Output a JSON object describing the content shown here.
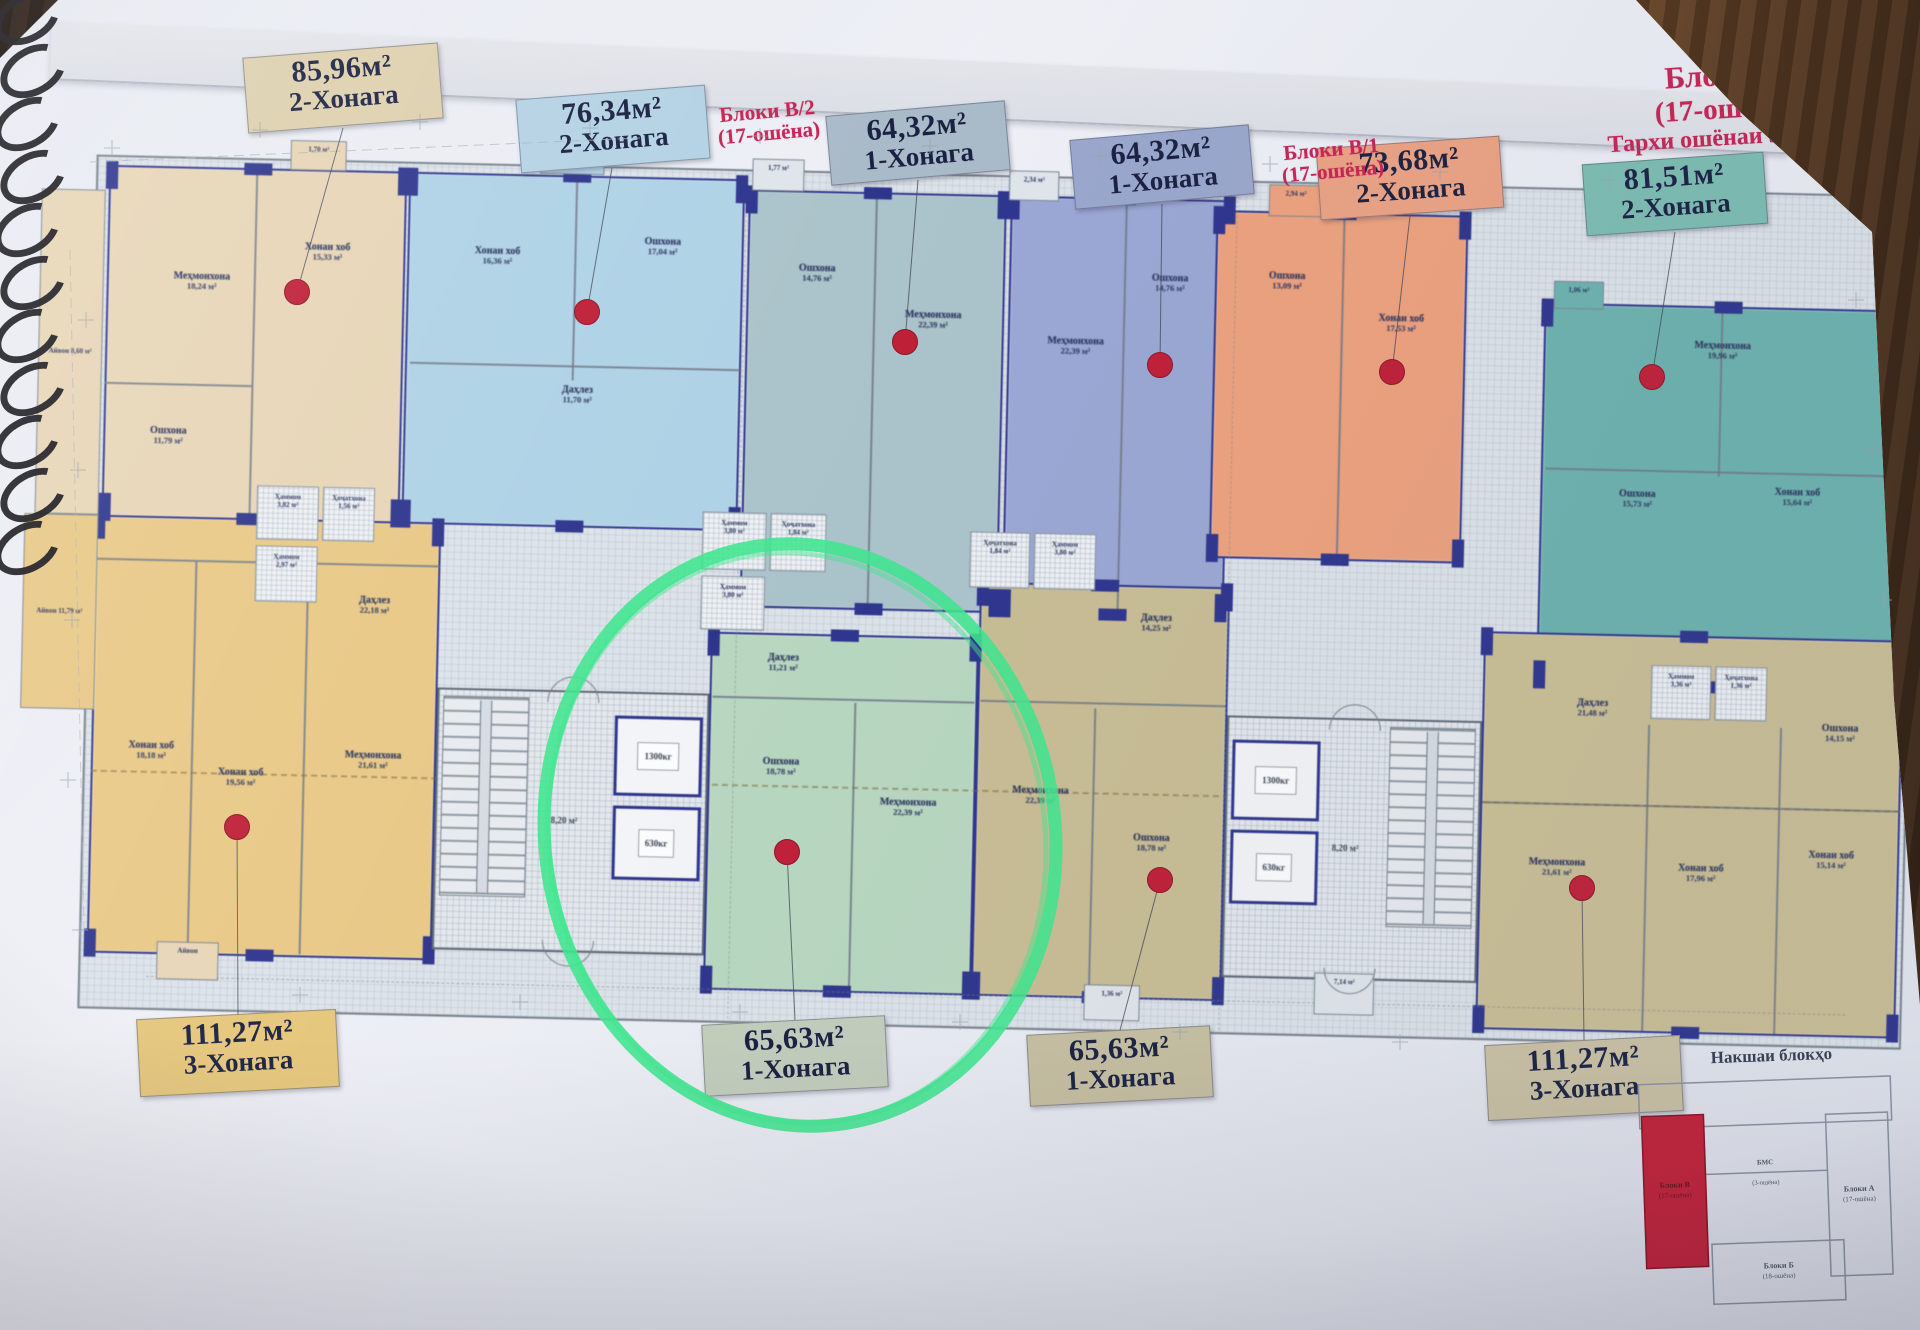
{
  "photo": {
    "paper_color": "#eaedf3",
    "accent_red": "#c62454",
    "wall_navy": "#2d3590",
    "marker_green": "#3fe68e",
    "dot_red": "#bf2038"
  },
  "header": {
    "title": {
      "line1": "Блоки В",
      "line2": "(17-ошёна)",
      "line3": "Тархи ошёнаи 5-16 ум"
    },
    "note_left": {
      "line1": "Блоки В/2",
      "line2": "(17-ошёна)"
    },
    "note_right": {
      "line1": "Блоки В/1",
      "line2": "(17-ошёна)"
    }
  },
  "tags": [
    {
      "id": "t8596",
      "area": "85,96м²",
      "rooms": "2-Хонага",
      "bg": "#ddd0ae",
      "x": 245,
      "y": 50,
      "w": 196,
      "h": 76,
      "rot": -4.5,
      "dot": [
        297,
        292
      ],
      "anchor": [
        343,
        128
      ]
    },
    {
      "id": "t7634",
      "area": "76,34м²",
      "rooms": "2-Хонага",
      "bg": "#b4d2e4",
      "x": 518,
      "y": 92,
      "w": 190,
      "h": 74,
      "rot": -4.5,
      "dot": [
        587,
        312
      ],
      "anchor": [
        612,
        168
      ]
    },
    {
      "id": "t6432a",
      "area": "64,32м²",
      "rooms": "1-Хонага",
      "bg": "#a9bac9",
      "x": 828,
      "y": 108,
      "w": 180,
      "h": 70,
      "rot": -5,
      "dot": [
        905,
        342
      ],
      "anchor": [
        918,
        180
      ]
    },
    {
      "id": "t6432b",
      "area": "64,32м²",
      "rooms": "1-Хонага",
      "bg": "#9aa7cc",
      "x": 1072,
      "y": 132,
      "w": 180,
      "h": 70,
      "rot": -5,
      "dot": [
        1160,
        365
      ],
      "anchor": [
        1162,
        204
      ]
    },
    {
      "id": "t7368",
      "area": "73,68м²",
      "rooms": "2-Хонага",
      "bg": "#eaa284",
      "x": 1318,
      "y": 142,
      "w": 184,
      "h": 72,
      "rot": -4,
      "dot": [
        1392,
        372
      ],
      "anchor": [
        1410,
        216
      ]
    },
    {
      "id": "t8151",
      "area": "81,51м²",
      "rooms": "2-Хонага",
      "bg": "#7cbcb1",
      "x": 1584,
      "y": 158,
      "w": 182,
      "h": 72,
      "rot": -4,
      "dot": [
        1652,
        377
      ],
      "anchor": [
        1675,
        232
      ]
    },
    {
      "id": "t11127L",
      "area": "111,27м²",
      "rooms": "3-Хонага",
      "bg": "#e5c67b",
      "x": 138,
      "y": 1014,
      "w": 200,
      "h": 78,
      "rot": -3,
      "dot": [
        237,
        827
      ],
      "anchor": [
        238,
        1014
      ]
    },
    {
      "id": "t6563L",
      "area": "65,63м²",
      "rooms": "1-Хонага",
      "bg": "#c2cdbc",
      "x": 703,
      "y": 1020,
      "w": 184,
      "h": 72,
      "rot": -3,
      "dot": [
        787,
        852
      ],
      "anchor": [
        795,
        1020
      ]
    },
    {
      "id": "t6563R",
      "area": "65,63м²",
      "rooms": "1-Хонага",
      "bg": "#c6bfa1",
      "x": 1028,
      "y": 1030,
      "w": 184,
      "h": 72,
      "rot": -3,
      "dot": [
        1160,
        880
      ],
      "anchor": [
        1120,
        1030
      ]
    },
    {
      "id": "t11127R",
      "area": "111,27м²",
      "rooms": "3-Хонага",
      "bg": "#cac2a4",
      "x": 1486,
      "y": 1040,
      "w": 196,
      "h": 76,
      "rot": -3,
      "dot": [
        1582,
        888
      ],
      "anchor": [
        1584,
        1040
      ]
    }
  ],
  "plan": {
    "units": [
      {
        "id": "85-96",
        "color": "#e8d5b5",
        "rect": [
          5,
          35,
          298,
          352
        ],
        "rooms": [
          {
            "l": "Меҳмонхона",
            "a": "18,24 м²",
            "x": 100,
            "y": 150
          },
          {
            "l": "Хонаи хоб",
            "a": "15,33 м²",
            "x": 225,
            "y": 118
          },
          {
            "l": "Ошхона",
            "a": "11,79 м²",
            "x": 70,
            "y": 305
          }
        ],
        "dividers": [
          [
            152,
            40,
            2,
            345
          ],
          [
            5,
            252,
            148,
            2
          ]
        ]
      },
      {
        "id": "76-34",
        "color": "#aed2e7",
        "rect": [
          305,
          35,
          336,
          352
        ],
        "rooms": [
          {
            "l": "Хонаи хоб",
            "a": "16,36 м²",
            "x": 395,
            "y": 118
          },
          {
            "l": "Ошхона",
            "a": "17,04 м²",
            "x": 560,
            "y": 105
          },
          {
            "l": "Даҳлез",
            "a": "11,70 м²",
            "x": 478,
            "y": 255
          }
        ],
        "dividers": [
          [
            472,
            40,
            2,
            200
          ],
          [
            310,
            225,
            330,
            2
          ]
        ]
      },
      {
        "id": "64-32-a",
        "color": "#aac3ca",
        "rect": [
          645,
          45,
          258,
          418
        ],
        "rooms": [
          {
            "l": "Ошхона",
            "a": "14,76 м²",
            "x": 715,
            "y": 128
          },
          {
            "l": "Меҳмонхона",
            "a": "22,39 м²",
            "x": 832,
            "y": 172
          }
        ],
        "dividers": [
          [
            772,
            50,
            2,
            408
          ]
        ]
      },
      {
        "id": "64-32-b",
        "color": "#9aa7d6",
        "rect": [
          907,
          45,
          222,
          418
        ],
        "rooms": [
          {
            "l": "Меҳмонхона",
            "a": "22,39 м²",
            "x": 975,
            "y": 195
          },
          {
            "l": "Ошхона",
            "a": "14,76 м²",
            "x": 1068,
            "y": 130
          }
        ],
        "dividers": [
          [
            1022,
            50,
            2,
            408
          ]
        ]
      },
      {
        "id": "73-68",
        "color": "#efa07b",
        "rect": [
          1113,
          55,
          252,
          348
        ],
        "rooms": [
          {
            "l": "Ошхона",
            "a": "13,09 м²",
            "x": 1185,
            "y": 125
          },
          {
            "l": "Хонаи хоб",
            "a": "17,53 м²",
            "x": 1300,
            "y": 165
          }
        ],
        "dividers": [
          [
            1240,
            60,
            2,
            338
          ]
        ]
      },
      {
        "id": "81-51",
        "color": "#6ab3ae",
        "rect": [
          1443,
          140,
          367,
          382
        ],
        "rooms": [
          {
            "l": "Меҳмонхона",
            "a": "19,96 м²",
            "x": 1622,
            "y": 185
          },
          {
            "l": "Хонаи хоб",
            "a": "15,64 м²",
            "x": 1700,
            "y": 330
          },
          {
            "l": "Ошхона",
            "a": "15,73 м²",
            "x": 1540,
            "y": 335
          }
        ],
        "dividers": [
          [
            1620,
            145,
            2,
            165
          ],
          [
            1448,
            305,
            358,
            2
          ]
        ]
      },
      {
        "id": "111-27-l",
        "color": "#e9c883",
        "rect": [
          0,
          385,
          345,
          438
        ],
        "rooms": [
          {
            "l": "Даҳлез",
            "a": "22,18 м²",
            "x": 280,
            "y": 470
          },
          {
            "l": "Хонаи хоб",
            "a": "18,18 м²",
            "x": 60,
            "y": 620
          },
          {
            "l": "Хонаи хоб",
            "a": "19,56 м²",
            "x": 150,
            "y": 645
          },
          {
            "l": "Меҳмонхона",
            "a": "21,61 м²",
            "x": 282,
            "y": 625
          }
        ],
        "dividers": [
          [
            100,
            430,
            2,
            390
          ],
          [
            212,
            432,
            2,
            388
          ],
          [
            2,
            428,
            342,
            2
          ]
        ]
      },
      {
        "id": "65-63-l",
        "color": "#b7d7bf",
        "rect": [
          617,
          488,
          268,
          358
        ],
        "rooms": [
          {
            "l": "Даҳлез",
            "a": "11,21 м²",
            "x": 690,
            "y": 518
          },
          {
            "l": "Ошхона",
            "a": "18,78 м²",
            "x": 690,
            "y": 622
          },
          {
            "l": "Меҳмонхона",
            "a": "22,39 м²",
            "x": 818,
            "y": 660
          }
        ],
        "dividers": [
          [
            762,
            556,
            2,
            288
          ],
          [
            620,
            552,
            262,
            2
          ]
        ]
      },
      {
        "id": "65-63-r",
        "color": "#c9bd92",
        "rect": [
          885,
          432,
          250,
          414
        ],
        "rooms": [
          {
            "l": "Даҳлез",
            "a": "14,25 м²",
            "x": 1062,
            "y": 470
          },
          {
            "l": "Меҳмонхона",
            "a": "22,39 м²",
            "x": 950,
            "y": 645
          },
          {
            "l": "Ошхона",
            "a": "18,78 м²",
            "x": 1062,
            "y": 690
          }
        ],
        "dividers": [
          [
            1002,
            556,
            2,
            288
          ],
          [
            888,
            550,
            245,
            2
          ]
        ]
      },
      {
        "id": "111-27-r",
        "color": "#cabe93",
        "rect": [
          1390,
          470,
          420,
          398
        ],
        "rooms": [
          {
            "l": "Даҳлез",
            "a": "21,48 м²",
            "x": 1500,
            "y": 545
          },
          {
            "l": "Меҳмонхона",
            "a": "21,61 м²",
            "x": 1468,
            "y": 705
          },
          {
            "l": "Хонаи хоб",
            "a": "17,96 м²",
            "x": 1612,
            "y": 708
          },
          {
            "l": "Хонаи хоб",
            "a": "15,14 м²",
            "x": 1742,
            "y": 692
          },
          {
            "l": "Ошхона",
            "a": "14,15 м²",
            "x": 1748,
            "y": 565
          }
        ],
        "dividers": [
          [
            1556,
            560,
            2,
            306
          ],
          [
            1688,
            560,
            2,
            306
          ],
          [
            1392,
            640,
            416,
            2
          ]
        ]
      }
    ],
    "cores": [
      {
        "id": "west",
        "x": 345,
        "y": 550,
        "w": 272,
        "h": 262,
        "stairs": "left",
        "lobby_area": "8,20 м²",
        "lift_big": "1300кг",
        "lift_small": "630кг"
      },
      {
        "id": "east",
        "x": 1135,
        "y": 560,
        "w": 255,
        "h": 262,
        "stairs": "right",
        "lobby_area": "8,20 м²",
        "lift_big": "1300кг",
        "lift_small": "630кг"
      }
    ],
    "baths": [
      [
        160,
        352,
        62,
        54,
        "Ҳаммом",
        "3,82 м²"
      ],
      [
        226,
        352,
        52,
        54,
        "Ҳоҷатхона",
        "1,56 м²"
      ],
      [
        160,
        412,
        62,
        56,
        "Ҳаммом",
        "2,97 м²"
      ],
      [
        606,
        368,
        64,
        58,
        "Ҳаммом",
        "3,80 м²"
      ],
      [
        674,
        368,
        56,
        58,
        "Ҳоҷатхона",
        "1,84 м²"
      ],
      [
        606,
        432,
        64,
        54,
        "Ҳаммом",
        "3,80 м²"
      ],
      [
        874,
        382,
        60,
        56,
        "Ҳоҷатхона",
        "1,84 м²"
      ],
      [
        938,
        382,
        62,
        56,
        "Ҳаммом",
        "3,80 м²"
      ],
      [
        1558,
        500,
        60,
        54,
        "Ҳаммом",
        "3,36 м²"
      ],
      [
        1622,
        500,
        52,
        54,
        "Ҳоҷатхона",
        "1,36 м²"
      ]
    ],
    "bumps_top": [
      [
        186,
        6,
        56,
        30,
        "1,70 м²",
        "#e8d5b5"
      ],
      [
        436,
        2,
        64,
        32,
        "3,10 м²",
        "#aed2e7"
      ],
      [
        648,
        14,
        52,
        32,
        "1,77 м²",
        "#dfe5ea"
      ],
      [
        905,
        20,
        50,
        30,
        "2,34 м²",
        "#dfe5ea"
      ],
      [
        1165,
        28,
        54,
        32,
        "2,94 м²",
        "#efa07b"
      ],
      [
        1452,
        118,
        50,
        28,
        "1,06 м²",
        "#6ab3ae"
      ]
    ],
    "bumps_bottom": [
      [
        70,
        810,
        62,
        38,
        "Айвон",
        "#e8d5b5"
      ],
      [
        1228,
        815,
        60,
        42,
        "7,14 м²",
        "#dfe5ea"
      ],
      [
        998,
        832,
        56,
        36,
        "1,36 м²",
        "#dfe5ea"
      ]
    ],
    "left_balconies": [
      [
        -62,
        60,
        64,
        325,
        "Айвон 8,60 м²",
        "#e8d5b5"
      ],
      [
        -72,
        385,
        74,
        195,
        "Айвон 11,79 м²",
        "#e9c883"
      ]
    ],
    "dim_marks": [
      [
        112,
        148
      ],
      [
        260,
        130
      ],
      [
        420,
        122
      ],
      [
        590,
        128
      ],
      [
        760,
        136
      ],
      [
        930,
        146
      ],
      [
        1100,
        156
      ],
      [
        1270,
        164
      ],
      [
        1440,
        172
      ],
      [
        1610,
        180
      ],
      [
        86,
        320
      ],
      [
        78,
        470
      ],
      [
        72,
        620
      ],
      [
        68,
        780
      ],
      [
        80,
        930
      ],
      [
        1856,
        300
      ],
      [
        1872,
        450
      ],
      [
        1884,
        600
      ],
      [
        300,
        995
      ],
      [
        520,
        1002
      ],
      [
        740,
        1012
      ],
      [
        960,
        1022
      ],
      [
        1180,
        1032
      ],
      [
        1400,
        1042
      ]
    ]
  },
  "keyplan": {
    "title": "Накшаи блокҳо",
    "highlight": {
      "name": "Блоки В",
      "floors": "(17-ошёна)"
    },
    "block_a": {
      "name": "Блоки А",
      "floors": "(17-ошёна)"
    },
    "block_b": {
      "name": "Блоки Б",
      "floors": "(18-ошёна)"
    },
    "link": {
      "name": "БМС",
      "floors": "(3-ошёна)"
    }
  }
}
